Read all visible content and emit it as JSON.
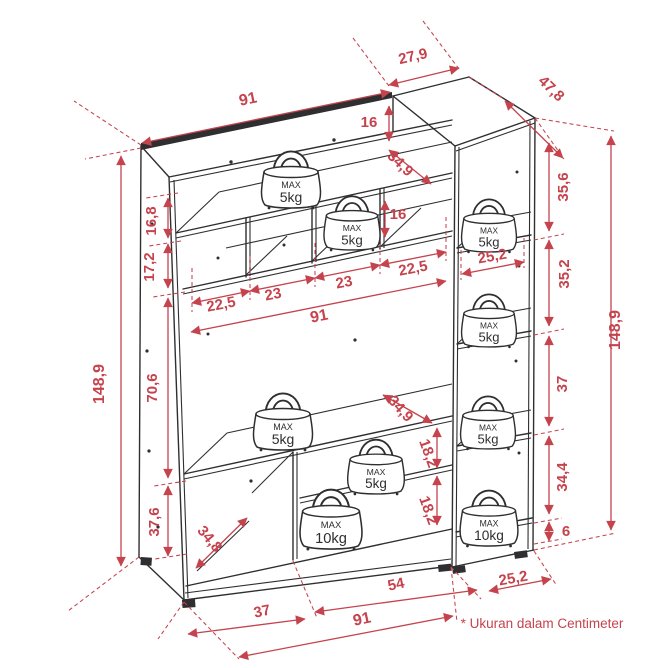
{
  "title": "Furniture dimension diagram",
  "colors": {
    "dimension_red": "#c5434d",
    "line_dark": "#2f2f31",
    "background": "#ffffff"
  },
  "footnote": {
    "label": "* Ukuran dalam Centimeter",
    "x": 542,
    "y": 628,
    "rot": 0,
    "fs": 13.5
  },
  "dimension_labels": [
    {
      "id": "width-top-91",
      "label": "91",
      "x": 249,
      "y": 104,
      "rot": -12,
      "fs": 16
    },
    {
      "id": "col-width-27-9",
      "label": "27,9",
      "x": 414,
      "y": 61,
      "rot": -13,
      "fs": 15
    },
    {
      "id": "col-depth-47-8",
      "label": "47,8",
      "x": 548,
      "y": 92,
      "rot": 44,
      "fs": 15
    },
    {
      "id": "shelf-top-16",
      "label": "16",
      "x": 369,
      "y": 127,
      "rot": 0,
      "fs": 15
    },
    {
      "id": "depth-top-34-9",
      "label": "34,9",
      "x": 397,
      "y": 167,
      "rot": 44,
      "fs": 15
    },
    {
      "id": "shelf-mid-16",
      "label": "16",
      "x": 398,
      "y": 219,
      "rot": 0,
      "fs": 15
    },
    {
      "id": "left-16-8",
      "label": "16,8",
      "x": 156,
      "y": 221,
      "rot": -90,
      "fs": 15
    },
    {
      "id": "left-17-2",
      "label": "17,2",
      "x": 154,
      "y": 267,
      "rot": -90,
      "fs": 15
    },
    {
      "id": "cubby-22-5-a",
      "label": "22,5",
      "x": 222,
      "y": 309,
      "rot": -11,
      "fs": 15
    },
    {
      "id": "cubby-23-a",
      "label": "23",
      "x": 274,
      "y": 299,
      "rot": -11,
      "fs": 15
    },
    {
      "id": "cubby-23-b",
      "label": "23",
      "x": 345,
      "y": 287,
      "rot": -11,
      "fs": 15
    },
    {
      "id": "cubby-22-5-b",
      "label": "22,5",
      "x": 414,
      "y": 273,
      "rot": -11,
      "fs": 15
    },
    {
      "id": "width-mid-91",
      "label": "91",
      "x": 320,
      "y": 321,
      "rot": -11,
      "fs": 16
    },
    {
      "id": "col-inner-25-2",
      "label": "25,2",
      "x": 493,
      "y": 261,
      "rot": -10,
      "fs": 15
    },
    {
      "id": "col-35-6",
      "label": "35,6",
      "x": 568,
      "y": 187,
      "rot": -90,
      "fs": 15
    },
    {
      "id": "col-35-2",
      "label": "35,2",
      "x": 569,
      "y": 274,
      "rot": -90,
      "fs": 15
    },
    {
      "id": "right-148-9",
      "label": "148,9",
      "x": 620,
      "y": 330,
      "rot": -90,
      "fs": 16
    },
    {
      "id": "left-148-9",
      "label": "148,9",
      "x": 104,
      "y": 384,
      "rot": -90,
      "fs": 16
    },
    {
      "id": "left-70-6",
      "label": "70,6",
      "x": 157,
      "y": 388,
      "rot": -90,
      "fs": 15
    },
    {
      "id": "left-37-6",
      "label": "37,6",
      "x": 159,
      "y": 522,
      "rot": -90,
      "fs": 15
    },
    {
      "id": "depth-34-8",
      "label": "34,8",
      "x": 206,
      "y": 542,
      "rot": 50,
      "fs": 15
    },
    {
      "id": "depth-mid-34-9",
      "label": "34,9",
      "x": 397,
      "y": 412,
      "rot": 48,
      "fs": 15
    },
    {
      "id": "right-18-2-a",
      "label": "18,2",
      "x": 424,
      "y": 455,
      "rot": 70,
      "fs": 15
    },
    {
      "id": "right-18-2-b",
      "label": "18,2",
      "x": 424,
      "y": 512,
      "rot": 70,
      "fs": 15
    },
    {
      "id": "col-37",
      "label": "37",
      "x": 567,
      "y": 384,
      "rot": -90,
      "fs": 15
    },
    {
      "id": "col-34-4",
      "label": "34,4",
      "x": 567,
      "y": 477,
      "rot": -90,
      "fs": 15
    },
    {
      "id": "col-6",
      "label": "6",
      "x": 566,
      "y": 536,
      "rot": 0,
      "fs": 15
    },
    {
      "id": "bottom-37",
      "label": "37",
      "x": 263,
      "y": 616,
      "rot": -12,
      "fs": 15
    },
    {
      "id": "bottom-54",
      "label": "54",
      "x": 397,
      "y": 589,
      "rot": -12,
      "fs": 15
    },
    {
      "id": "bottom-91",
      "label": "91",
      "x": 363,
      "y": 624,
      "rot": -12,
      "fs": 16
    },
    {
      "id": "bottom-25-2",
      "label": "25,2",
      "x": 514,
      "y": 583,
      "rot": -10,
      "fs": 15
    }
  ],
  "weights": [
    {
      "id": "w-top-shelf",
      "max": "MAX",
      "load": "5kg",
      "x": 291,
      "base": 207,
      "s": 1.0
    },
    {
      "id": "w-cubby-shelf",
      "max": "MAX",
      "load": "5kg",
      "x": 352,
      "base": 249,
      "s": 0.95
    },
    {
      "id": "w-col-shelf1",
      "max": "MAX",
      "load": "5kg",
      "x": 489,
      "base": 251,
      "s": 0.93
    },
    {
      "id": "w-col-shelf2",
      "max": "MAX",
      "load": "5kg",
      "x": 489,
      "base": 346,
      "s": 0.93
    },
    {
      "id": "w-mid-shelf",
      "max": "MAX",
      "load": "5kg",
      "x": 283,
      "base": 449,
      "s": 1.0
    },
    {
      "id": "w-lower-shelf",
      "max": "MAX",
      "load": "5kg",
      "x": 376,
      "base": 493,
      "s": 0.96
    },
    {
      "id": "w-col-shelf3",
      "max": "MAX",
      "load": "5kg",
      "x": 488,
      "base": 448,
      "s": 0.93
    },
    {
      "id": "w-bottom-10kg",
      "max": "MAX",
      "load": "10kg",
      "x": 331,
      "base": 548,
      "s": 1.05
    },
    {
      "id": "w-col-bottom-10kg",
      "max": "MAX",
      "load": "10kg",
      "x": 489,
      "base": 545,
      "s": 0.98
    }
  ]
}
